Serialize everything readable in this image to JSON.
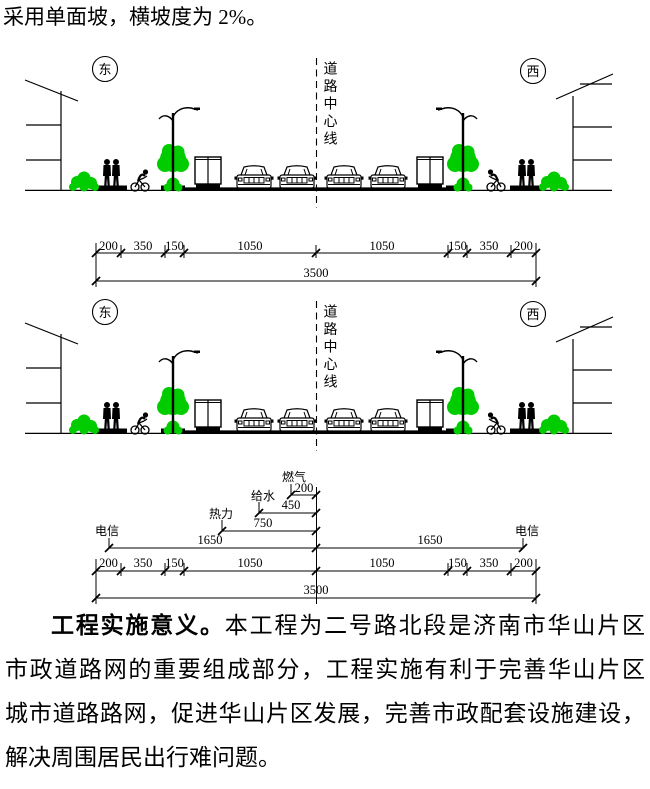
{
  "intro": "采用单面坡，横坡度为 2%。",
  "scene": {
    "east": "东",
    "west": "西",
    "centerline": "道路中心线"
  },
  "dims": {
    "segments": [
      "200",
      "350",
      "150",
      "1050",
      "1050",
      "150",
      "350",
      "200"
    ],
    "total": "3500"
  },
  "utilities": {
    "gas": {
      "label": "燃气",
      "value": "200"
    },
    "water": {
      "label": "给水",
      "value": "450"
    },
    "heat": {
      "label": "热力",
      "value": "750"
    },
    "telecom_left": {
      "label": "电信",
      "value": "1650"
    },
    "telecom_right": {
      "label": "电信",
      "value": "1650"
    }
  },
  "paragraph": {
    "line1_bold": "工程实施意义。",
    "line1_rest": "本工程为二号路北段是济南市华山片区",
    "line2": "市政道路网的重要组成部分，工程实施有利于完善华山片区",
    "line3": "城市道路路网，促进华山片区发展，完善市政配套设施建设，",
    "line4": "解决周围居民出行难问题。"
  },
  "colors": {
    "vegetation": "#00cc00",
    "ink": "#000000"
  }
}
